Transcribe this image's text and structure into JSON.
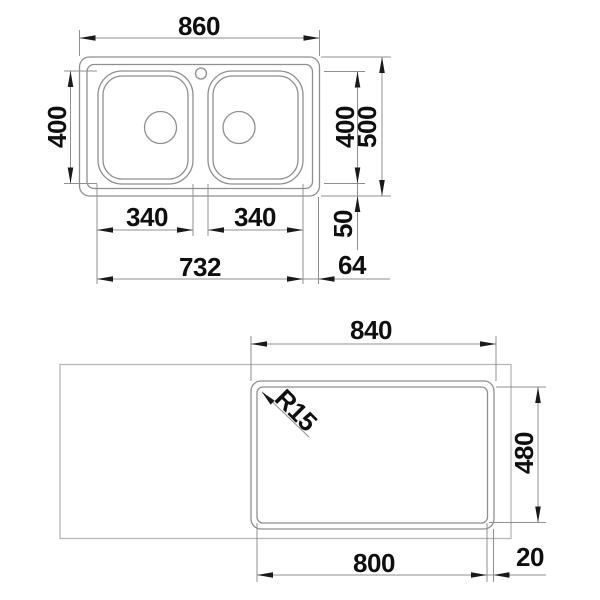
{
  "document": {
    "type": "technical-drawing",
    "subject": "double-bowl inset sink installation drawing, top view and underside cutout view"
  },
  "top_view": {
    "labels": {
      "overall_width": "860",
      "overall_depth": "500",
      "bowl_depth_left": "400",
      "bowl_depth_right": "400",
      "bowl_width_left": "340",
      "bowl_width_right": "340",
      "bowls_outer_span": "732",
      "right_edge_offset": "64",
      "bottom_edge_offset": "50"
    }
  },
  "bottom_view": {
    "labels": {
      "sink_base_width": "840",
      "cutout_width": "800",
      "cutout_depth": "480",
      "cutout_corner_radius": "R15",
      "edge_clearance": "20"
    }
  },
  "colors": {
    "background": "#ffffff",
    "drawing_line": "#8f8f8f",
    "countertop_line": "#b7b7b7",
    "arrow": "#1a1a1a",
    "text": "#0f0f0f"
  }
}
